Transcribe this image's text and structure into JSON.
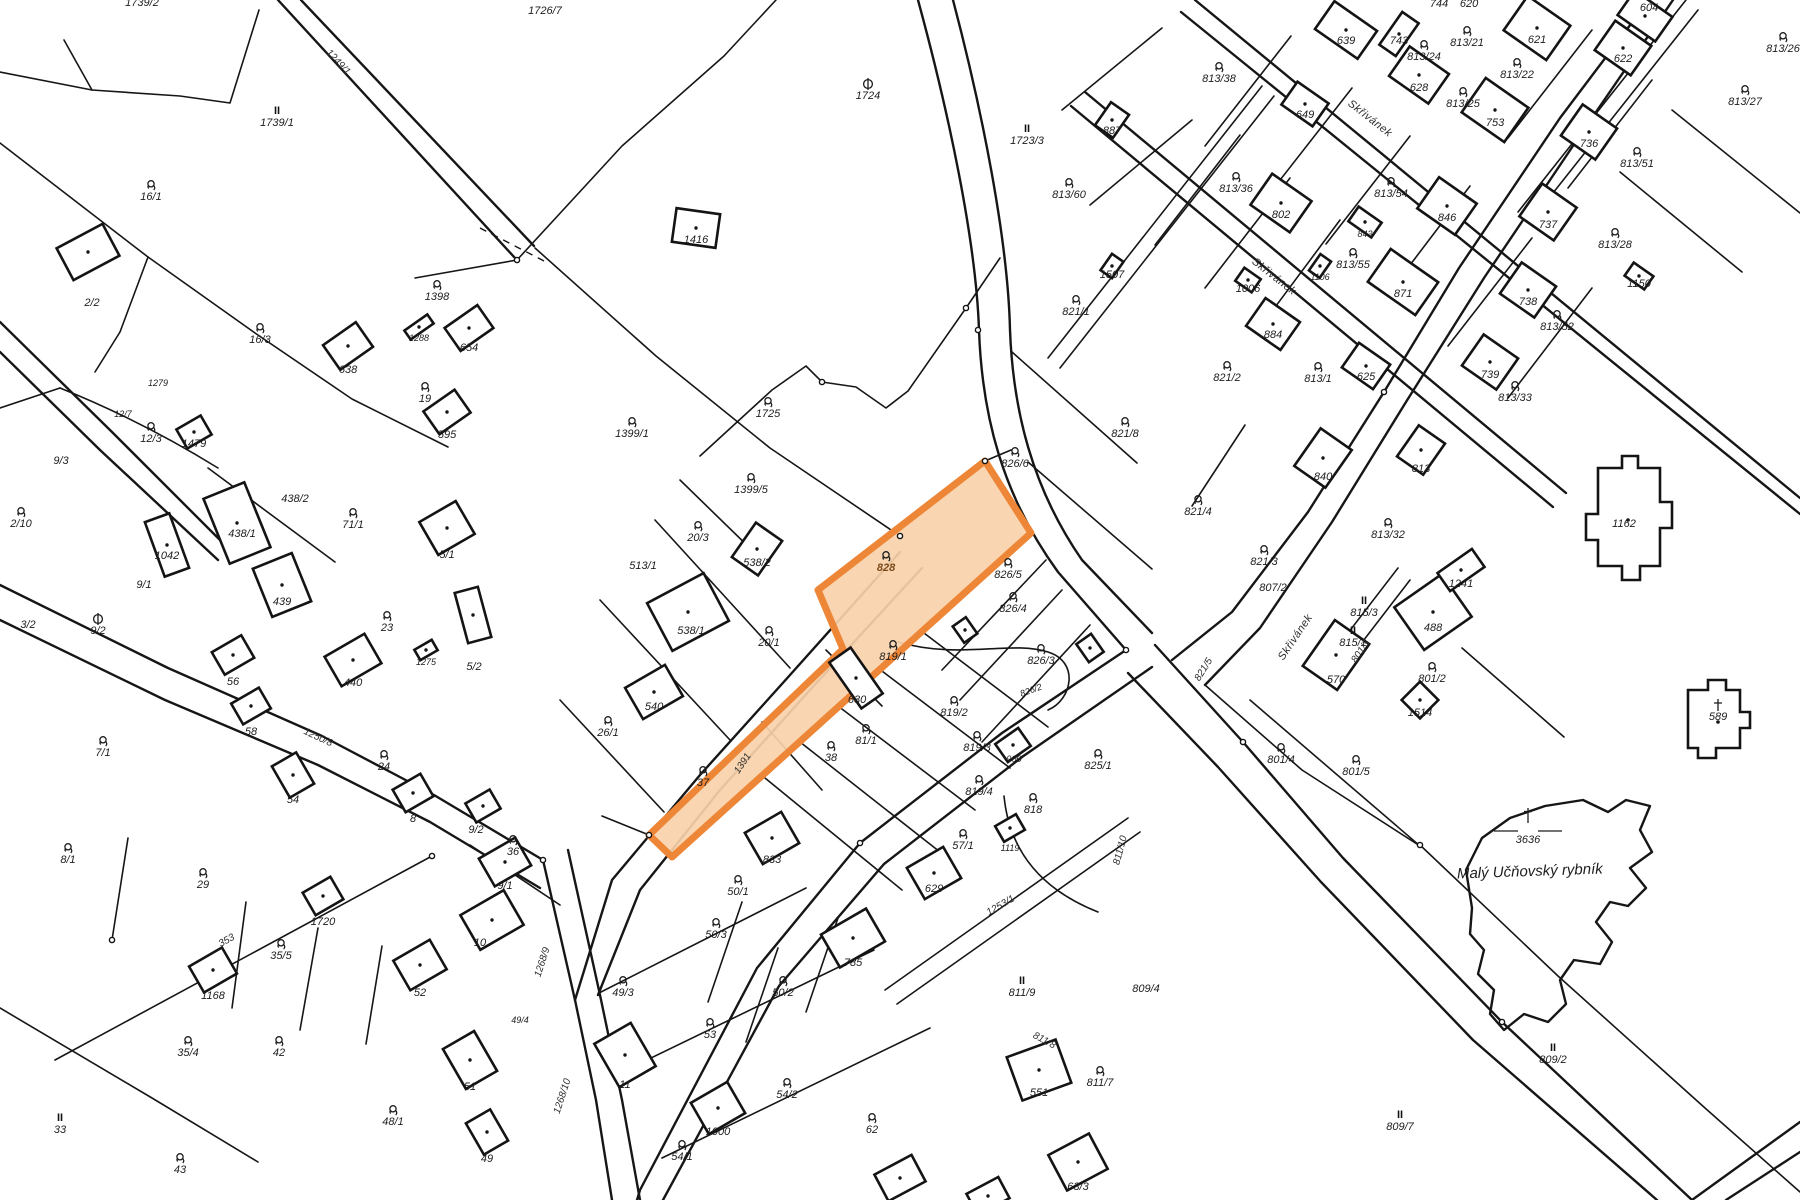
{
  "map_type": "cadastral-parcel-map",
  "colors": {
    "background": "#ffffff",
    "line": "#161616",
    "highlight_fill": "#f9d3aa",
    "highlight_stroke": "#ee8637",
    "highlight_label": "#7c4a1c"
  },
  "highlight": {
    "parcel": "828"
  },
  "pond": {
    "name": "Malý Učňovský rybník",
    "number": "3636"
  },
  "street_name": "Skřivánek",
  "labels": [
    {
      "t": "1739/2",
      "x": 142,
      "y": 6
    },
    {
      "t": "1739/1",
      "x": 277,
      "y": 126,
      "s": "II"
    },
    {
      "t": "1726/7",
      "x": 545,
      "y": 14
    },
    {
      "t": "1249/1",
      "x": 336,
      "y": 64,
      "r": 47,
      "f": "rdl"
    },
    {
      "t": "16/1",
      "x": 151,
      "y": 200,
      "s": "g"
    },
    {
      "t": "2/2",
      "x": 92,
      "y": 306
    },
    {
      "t": "16/3",
      "x": 260,
      "y": 343,
      "s": "g"
    },
    {
      "t": "1398",
      "x": 437,
      "y": 300,
      "s": "g"
    },
    {
      "t": "1288",
      "x": 419,
      "y": 341,
      "f": "sm"
    },
    {
      "t": "654",
      "x": 469,
      "y": 351
    },
    {
      "t": "638",
      "x": 348,
      "y": 373
    },
    {
      "t": "19",
      "x": 425,
      "y": 402,
      "s": "g"
    },
    {
      "t": "595",
      "x": 447,
      "y": 438
    },
    {
      "t": "12/7",
      "x": 123,
      "y": 417,
      "f": "sm"
    },
    {
      "t": "12/3",
      "x": 151,
      "y": 442,
      "s": "g"
    },
    {
      "t": "1479",
      "x": 194,
      "y": 447
    },
    {
      "t": "1279",
      "x": 158,
      "y": 386,
      "f": "sm"
    },
    {
      "t": "9/3",
      "x": 61,
      "y": 464
    },
    {
      "t": "2/10",
      "x": 21,
      "y": 527,
      "s": "g"
    },
    {
      "t": "1042",
      "x": 167,
      "y": 559
    },
    {
      "t": "9/1",
      "x": 144,
      "y": 588
    },
    {
      "t": "3/2",
      "x": 28,
      "y": 628
    },
    {
      "t": "9/2",
      "x": 98,
      "y": 634,
      "s": "cb"
    },
    {
      "t": "1724",
      "x": 868,
      "y": 99,
      "s": "cb"
    },
    {
      "t": "1723/3",
      "x": 1027,
      "y": 144,
      "s": "II"
    },
    {
      "t": "1416",
      "x": 696,
      "y": 243
    },
    {
      "t": "1725",
      "x": 768,
      "y": 417,
      "s": "g"
    },
    {
      "t": "1399/1",
      "x": 632,
      "y": 437,
      "s": "g"
    },
    {
      "t": "1399/5",
      "x": 751,
      "y": 493,
      "s": "g"
    },
    {
      "t": "887",
      "x": 1112,
      "y": 134
    },
    {
      "t": "813/60",
      "x": 1069,
      "y": 198,
      "s": "g"
    },
    {
      "t": "1507",
      "x": 1112,
      "y": 278
    },
    {
      "t": "821/1",
      "x": 1076,
      "y": 315,
      "s": "g"
    },
    {
      "t": "821/8",
      "x": 1125,
      "y": 437,
      "s": "g"
    },
    {
      "t": "826/6",
      "x": 1015,
      "y": 467,
      "s": "g"
    },
    {
      "t": "744",
      "x": 1439,
      "y": 7
    },
    {
      "t": "620",
      "x": 1469,
      "y": 7
    },
    {
      "t": "639",
      "x": 1346,
      "y": 44
    },
    {
      "t": "743",
      "x": 1399,
      "y": 44
    },
    {
      "t": "813/24",
      "x": 1424,
      "y": 60,
      "s": "g"
    },
    {
      "t": "813/21",
      "x": 1467,
      "y": 46,
      "s": "g"
    },
    {
      "t": "621",
      "x": 1537,
      "y": 43
    },
    {
      "t": "604",
      "x": 1649,
      "y": 11
    },
    {
      "t": "813/26",
      "x": 1783,
      "y": 52,
      "s": "g"
    },
    {
      "t": "622",
      "x": 1623,
      "y": 62
    },
    {
      "t": "813/38",
      "x": 1219,
      "y": 82,
      "s": "g"
    },
    {
      "t": "649",
      "x": 1305,
      "y": 118
    },
    {
      "t": "628",
      "x": 1419,
      "y": 91
    },
    {
      "t": "813/22",
      "x": 1517,
      "y": 78,
      "s": "g"
    },
    {
      "t": "813/25",
      "x": 1463,
      "y": 107,
      "s": "g"
    },
    {
      "t": "753",
      "x": 1495,
      "y": 126
    },
    {
      "t": "736",
      "x": 1589,
      "y": 147
    },
    {
      "t": "813/27",
      "x": 1745,
      "y": 105,
      "s": "g"
    },
    {
      "t": "813/36",
      "x": 1236,
      "y": 192,
      "s": "g"
    },
    {
      "t": "802",
      "x": 1281,
      "y": 218
    },
    {
      "t": "813/54",
      "x": 1391,
      "y": 197,
      "s": "g"
    },
    {
      "t": "843",
      "x": 1365,
      "y": 237,
      "f": "sm"
    },
    {
      "t": "846",
      "x": 1447,
      "y": 221
    },
    {
      "t": "813/51",
      "x": 1637,
      "y": 167,
      "s": "g"
    },
    {
      "t": "737",
      "x": 1548,
      "y": 228
    },
    {
      "t": "813/28",
      "x": 1615,
      "y": 248,
      "s": "g"
    },
    {
      "t": "1150",
      "x": 1639,
      "y": 287
    },
    {
      "t": "738",
      "x": 1528,
      "y": 305
    },
    {
      "t": "813/52",
      "x": 1557,
      "y": 330,
      "s": "g"
    },
    {
      "t": "739",
      "x": 1490,
      "y": 378
    },
    {
      "t": "813/33",
      "x": 1515,
      "y": 401,
      "s": "g"
    },
    {
      "t": "1106",
      "x": 1320,
      "y": 280,
      "f": "sm"
    },
    {
      "t": "813/55",
      "x": 1353,
      "y": 268,
      "s": "g"
    },
    {
      "t": "871",
      "x": 1403,
      "y": 297
    },
    {
      "t": "1006",
      "x": 1248,
      "y": 292
    },
    {
      "t": "884",
      "x": 1273,
      "y": 338
    },
    {
      "t": "821/2",
      "x": 1227,
      "y": 381,
      "s": "g"
    },
    {
      "t": "813/1",
      "x": 1318,
      "y": 382,
      "s": "g"
    },
    {
      "t": "625",
      "x": 1366,
      "y": 380
    },
    {
      "t": "Skřivánek",
      "x": 1368,
      "y": 121,
      "r": 38,
      "f": "st"
    },
    {
      "t": "Skřivánek",
      "x": 1272,
      "y": 279,
      "r": 38,
      "f": "st"
    },
    {
      "t": "821/4",
      "x": 1198,
      "y": 515,
      "s": "g"
    },
    {
      "t": "821/3",
      "x": 1264,
      "y": 565,
      "s": "g"
    },
    {
      "t": "840",
      "x": 1323,
      "y": 480
    },
    {
      "t": "813",
      "x": 1421,
      "y": 472
    },
    {
      "t": "813/32",
      "x": 1388,
      "y": 538,
      "s": "g"
    },
    {
      "t": "1241",
      "x": 1461,
      "y": 587
    },
    {
      "t": "488",
      "x": 1433,
      "y": 631
    },
    {
      "t": "815/3",
      "x": 1364,
      "y": 616,
      "s": "II"
    },
    {
      "t": "815/1",
      "x": 1353,
      "y": 646,
      "s": "II"
    },
    {
      "t": "570",
      "x": 1336,
      "y": 683
    },
    {
      "t": "Skřivánek",
      "x": 1298,
      "y": 639,
      "r": -56,
      "f": "st"
    },
    {
      "t": "801/3",
      "x": 1363,
      "y": 653,
      "r": -56,
      "f": "rdl"
    },
    {
      "t": "807/2",
      "x": 1273,
      "y": 591
    },
    {
      "t": "821/5",
      "x": 1206,
      "y": 671,
      "r": -58,
      "f": "rdl"
    },
    {
      "t": "801/2",
      "x": 1432,
      "y": 682,
      "s": "g"
    },
    {
      "t": "1514",
      "x": 1420,
      "y": 716
    },
    {
      "t": "801/4",
      "x": 1281,
      "y": 763,
      "s": "g"
    },
    {
      "t": "801/5",
      "x": 1356,
      "y": 775,
      "s": "g"
    },
    {
      "t": "1162",
      "x": 1624,
      "y": 527
    },
    {
      "t": "589",
      "x": 1718,
      "y": 720,
      "s": "cross"
    },
    {
      "t": "3636",
      "x": 1528,
      "y": 843,
      "s": "pond"
    },
    {
      "t": "826/5",
      "x": 1008,
      "y": 578,
      "s": "g"
    },
    {
      "t": "826/4",
      "x": 1013,
      "y": 612,
      "s": "g"
    },
    {
      "t": "826/3",
      "x": 1041,
      "y": 664,
      "s": "g"
    },
    {
      "t": "826/2",
      "x": 1032,
      "y": 693,
      "r": -20,
      "f": "sm"
    },
    {
      "t": "819/1",
      "x": 893,
      "y": 660,
      "s": "g"
    },
    {
      "t": "630",
      "x": 857,
      "y": 703
    },
    {
      "t": "819/2",
      "x": 954,
      "y": 716,
      "s": "g"
    },
    {
      "t": "819/3",
      "x": 977,
      "y": 751,
      "s": "g"
    },
    {
      "t": "900",
      "x": 1014,
      "y": 762,
      "f": "sm"
    },
    {
      "t": "819/4",
      "x": 979,
      "y": 795,
      "s": "g"
    },
    {
      "t": "818",
      "x": 1033,
      "y": 813,
      "s": "g"
    },
    {
      "t": "825/1",
      "x": 1098,
      "y": 769,
      "s": "g"
    },
    {
      "t": "20/3",
      "x": 698,
      "y": 541,
      "s": "g"
    },
    {
      "t": "513/1",
      "x": 643,
      "y": 569
    },
    {
      "t": "538/2",
      "x": 757,
      "y": 566
    },
    {
      "t": "538/1",
      "x": 691,
      "y": 634
    },
    {
      "t": "20/1",
      "x": 769,
      "y": 646,
      "s": "g"
    },
    {
      "t": "38",
      "x": 831,
      "y": 761,
      "s": "g"
    },
    {
      "t": "37",
      "x": 703,
      "y": 786,
      "s": "g"
    },
    {
      "t": "540",
      "x": 654,
      "y": 710
    },
    {
      "t": "26/1",
      "x": 608,
      "y": 736,
      "s": "g"
    },
    {
      "t": "1391",
      "x": 745,
      "y": 765,
      "r": -56,
      "f": "rdl"
    },
    {
      "t": "81/1",
      "x": 866,
      "y": 744,
      "s": "g"
    },
    {
      "t": "438/2",
      "x": 295,
      "y": 502
    },
    {
      "t": "438/1",
      "x": 242,
      "y": 537
    },
    {
      "t": "439",
      "x": 282,
      "y": 605
    },
    {
      "t": "71/1",
      "x": 353,
      "y": 528,
      "s": "g"
    },
    {
      "t": "23",
      "x": 387,
      "y": 631,
      "s": "g"
    },
    {
      "t": "5/1",
      "x": 447,
      "y": 558
    },
    {
      "t": "1275",
      "x": 426,
      "y": 665,
      "f": "sm"
    },
    {
      "t": "5/2",
      "x": 474,
      "y": 670
    },
    {
      "t": "440",
      "x": 353,
      "y": 686
    },
    {
      "t": "56",
      "x": 233,
      "y": 685
    },
    {
      "t": "58",
      "x": 251,
      "y": 735
    },
    {
      "t": "7/1",
      "x": 103,
      "y": 756,
      "s": "g"
    },
    {
      "t": "24",
      "x": 384,
      "y": 770,
      "s": "g"
    },
    {
      "t": "54",
      "x": 293,
      "y": 803
    },
    {
      "t": "8",
      "x": 413,
      "y": 822
    },
    {
      "t": "9/2",
      "x": 476,
      "y": 833
    },
    {
      "t": "1250/8",
      "x": 317,
      "y": 740,
      "r": 25,
      "f": "rdl"
    },
    {
      "t": "8/1",
      "x": 68,
      "y": 863,
      "s": "g"
    },
    {
      "t": "29",
      "x": 203,
      "y": 888,
      "s": "g"
    },
    {
      "t": "1720",
      "x": 323,
      "y": 925
    },
    {
      "t": "35/5",
      "x": 281,
      "y": 959,
      "s": "g"
    },
    {
      "t": "1168",
      "x": 213,
      "y": 999
    },
    {
      "t": "52",
      "x": 420,
      "y": 996
    },
    {
      "t": "35/4",
      "x": 188,
      "y": 1056,
      "s": "g"
    },
    {
      "t": "42",
      "x": 279,
      "y": 1056,
      "s": "g"
    },
    {
      "t": "33",
      "x": 60,
      "y": 1133,
      "s": "II"
    },
    {
      "t": "43",
      "x": 180,
      "y": 1173,
      "s": "g"
    },
    {
      "t": "353",
      "x": 228,
      "y": 943,
      "r": -29,
      "f": "rdl"
    },
    {
      "t": "9/1",
      "x": 505,
      "y": 889
    },
    {
      "t": "36",
      "x": 513,
      "y": 855,
      "s": "g"
    },
    {
      "t": "10",
      "x": 480,
      "y": 946
    },
    {
      "t": "49/4",
      "x": 520,
      "y": 1023,
      "f": "sm"
    },
    {
      "t": "51",
      "x": 470,
      "y": 1090
    },
    {
      "t": "48/1",
      "x": 393,
      "y": 1125,
      "s": "g"
    },
    {
      "t": "49",
      "x": 487,
      "y": 1162
    },
    {
      "t": "1268/9",
      "x": 545,
      "y": 963,
      "r": -72,
      "f": "rdl"
    },
    {
      "t": "1268/10",
      "x": 565,
      "y": 1097,
      "r": -72,
      "f": "rdl"
    },
    {
      "t": "49/3",
      "x": 623,
      "y": 996,
      "s": "g"
    },
    {
      "t": "11",
      "x": 625,
      "y": 1088
    },
    {
      "t": "53",
      "x": 710,
      "y": 1038,
      "s": "g"
    },
    {
      "t": "50/1",
      "x": 738,
      "y": 895,
      "s": "g"
    },
    {
      "t": "50/3",
      "x": 716,
      "y": 938,
      "s": "g"
    },
    {
      "t": "50/2",
      "x": 783,
      "y": 996,
      "s": "g"
    },
    {
      "t": "833",
      "x": 772,
      "y": 863
    },
    {
      "t": "785",
      "x": 853,
      "y": 966
    },
    {
      "t": "54/2",
      "x": 787,
      "y": 1098,
      "s": "g"
    },
    {
      "t": "1000",
      "x": 718,
      "y": 1135
    },
    {
      "t": "54/1",
      "x": 682,
      "y": 1160,
      "s": "g"
    },
    {
      "t": "62",
      "x": 872,
      "y": 1133,
      "s": "g"
    },
    {
      "t": "57/1",
      "x": 963,
      "y": 849,
      "s": "g"
    },
    {
      "t": "1119",
      "x": 1010,
      "y": 851,
      "f": "sm"
    },
    {
      "t": "629",
      "x": 934,
      "y": 892
    },
    {
      "t": "551",
      "x": 1039,
      "y": 1096
    },
    {
      "t": "811/7",
      "x": 1100,
      "y": 1086,
      "s": "g"
    },
    {
      "t": "1253/1",
      "x": 1002,
      "y": 908,
      "r": -30,
      "f": "rdl"
    },
    {
      "t": "811/9",
      "x": 1022,
      "y": 996,
      "s": "II"
    },
    {
      "t": "809/4",
      "x": 1146,
      "y": 992
    },
    {
      "t": "811/10",
      "x": 1123,
      "y": 851,
      "r": -75,
      "f": "rdl"
    },
    {
      "t": "811/8",
      "x": 1043,
      "y": 1043,
      "r": 28,
      "f": "rdl"
    },
    {
      "t": "63/3",
      "x": 1078,
      "y": 1190
    },
    {
      "t": "809/7",
      "x": 1400,
      "y": 1130,
      "s": "II"
    },
    {
      "t": "809/2",
      "x": 1553,
      "y": 1063,
      "s": "II"
    }
  ]
}
